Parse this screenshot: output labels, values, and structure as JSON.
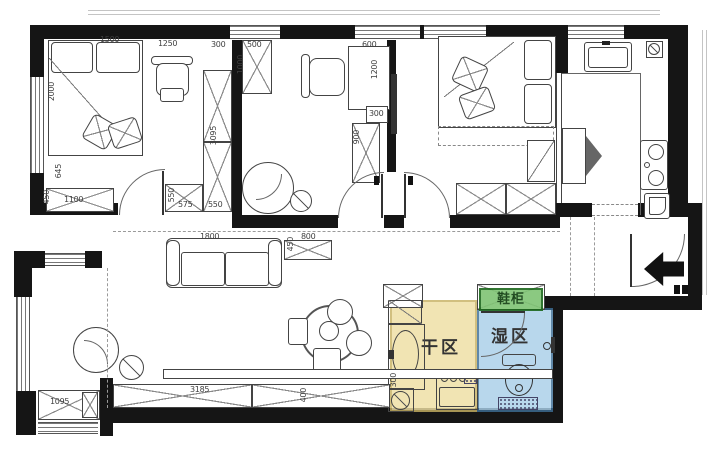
{
  "zones": {
    "dry": {
      "label": "干区",
      "fill": "#EFDFA3",
      "border": "#C7B264"
    },
    "wet": {
      "label": "湿区",
      "fill": "#A9CFE8",
      "border": "#3E6F96"
    },
    "shoe": {
      "label": "鞋柜",
      "fill": "#7FC474",
      "border": "#1C681C"
    }
  },
  "dimensions": [
    {
      "text": "1500",
      "x": 100,
      "y": 36
    },
    {
      "text": "1250",
      "x": 158,
      "y": 40
    },
    {
      "text": "300",
      "x": 211,
      "y": 41
    },
    {
      "text": "500",
      "x": 247,
      "y": 41
    },
    {
      "text": "600",
      "x": 362,
      "y": 41
    },
    {
      "text": "2000",
      "x": 48,
      "y": 82,
      "v": 1
    },
    {
      "text": "1000",
      "x": 237,
      "y": 55,
      "v": 1
    },
    {
      "text": "1200",
      "x": 371,
      "y": 60,
      "v": 1
    },
    {
      "text": "3095",
      "x": 210,
      "y": 126,
      "v": 1
    },
    {
      "text": "300",
      "x": 369,
      "y": 110
    },
    {
      "text": "900",
      "x": 353,
      "y": 130,
      "v": 1
    },
    {
      "text": "645",
      "x": 55,
      "y": 164,
      "v": 1
    },
    {
      "text": "450",
      "x": 43,
      "y": 190,
      "v": 1
    },
    {
      "text": "1100",
      "x": 64,
      "y": 196
    },
    {
      "text": "550",
      "x": 168,
      "y": 188,
      "v": 1
    },
    {
      "text": "575",
      "x": 178,
      "y": 201
    },
    {
      "text": "550",
      "x": 208,
      "y": 201
    },
    {
      "text": "1800",
      "x": 200,
      "y": 233
    },
    {
      "text": "450",
      "x": 287,
      "y": 237,
      "v": 1
    },
    {
      "text": "800",
      "x": 301,
      "y": 233
    },
    {
      "text": "3185",
      "x": 190,
      "y": 386
    },
    {
      "text": "400",
      "x": 300,
      "y": 388,
      "v": 1
    },
    {
      "text": "1095",
      "x": 50,
      "y": 398
    },
    {
      "text": "300",
      "x": 390,
      "y": 373,
      "v": 1
    }
  ]
}
